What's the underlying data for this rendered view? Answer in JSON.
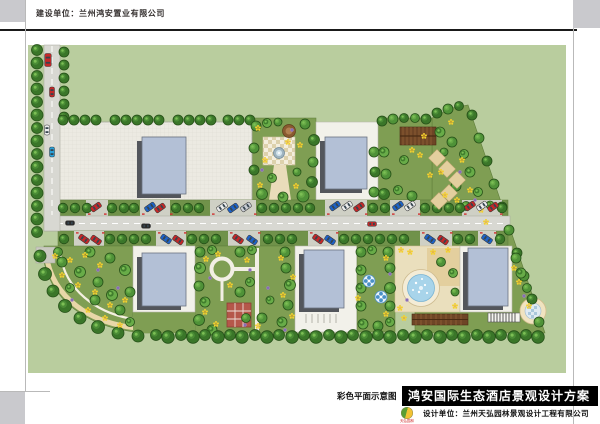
{
  "page": {
    "header": {
      "label": "建设单位：兰州鸿安置业有限公司"
    },
    "footer": {
      "drawing_type_label": "彩色平面示意图",
      "project_title": "鸿安国际生态酒店景观设计方案",
      "design_unit_label": "设计单位：兰州天弘园林景观设计工程有限公司",
      "logo_text": "天弘园林"
    }
  },
  "palette": {
    "corner_gray": "#c9c9cd",
    "title_bar_bg": "#000000",
    "title_bar_text": "#ffffff",
    "site_green": "#b9cd9e",
    "garden_green": "#7f9e53",
    "garden_edge": "#5e7d3a",
    "plaza_gray": "#eceae2",
    "pad_white": "#f2f1ea",
    "road_gray": "#d8d8d2",
    "strip_green": "#70924a",
    "bay_gray": "#cfd0c5",
    "building_fill": "#b3c0d6",
    "building_stroke": "#6a7280",
    "building_shadow": "#53565c",
    "pool_water": "#a8d4ea",
    "deck_cream": "#eadfbd",
    "sand_tan": "#e3cf9e",
    "path_tan": "#e9dcba",
    "pergola_brown": "#6e4526",
    "brick_red": "#b5574a",
    "flower_yellow": "#f3d02e",
    "flower_center": "#e8a81e",
    "flower_purple": "#9b7fc4",
    "tree_dark": "#3a7629",
    "tree_mid": "#4f9238",
    "tree_light": "#68ac48",
    "tree_inner": "#7cbf55",
    "tree_stroke": "#265018",
    "car_red": "#c62828",
    "car_blue": "#1e63c8",
    "car_white": "#ececec",
    "car_gray": "#c9cdd4",
    "car_cyan": "#2aa0d8",
    "car_dark": "#2a2a2a",
    "tick_red": "#d03030"
  }
}
